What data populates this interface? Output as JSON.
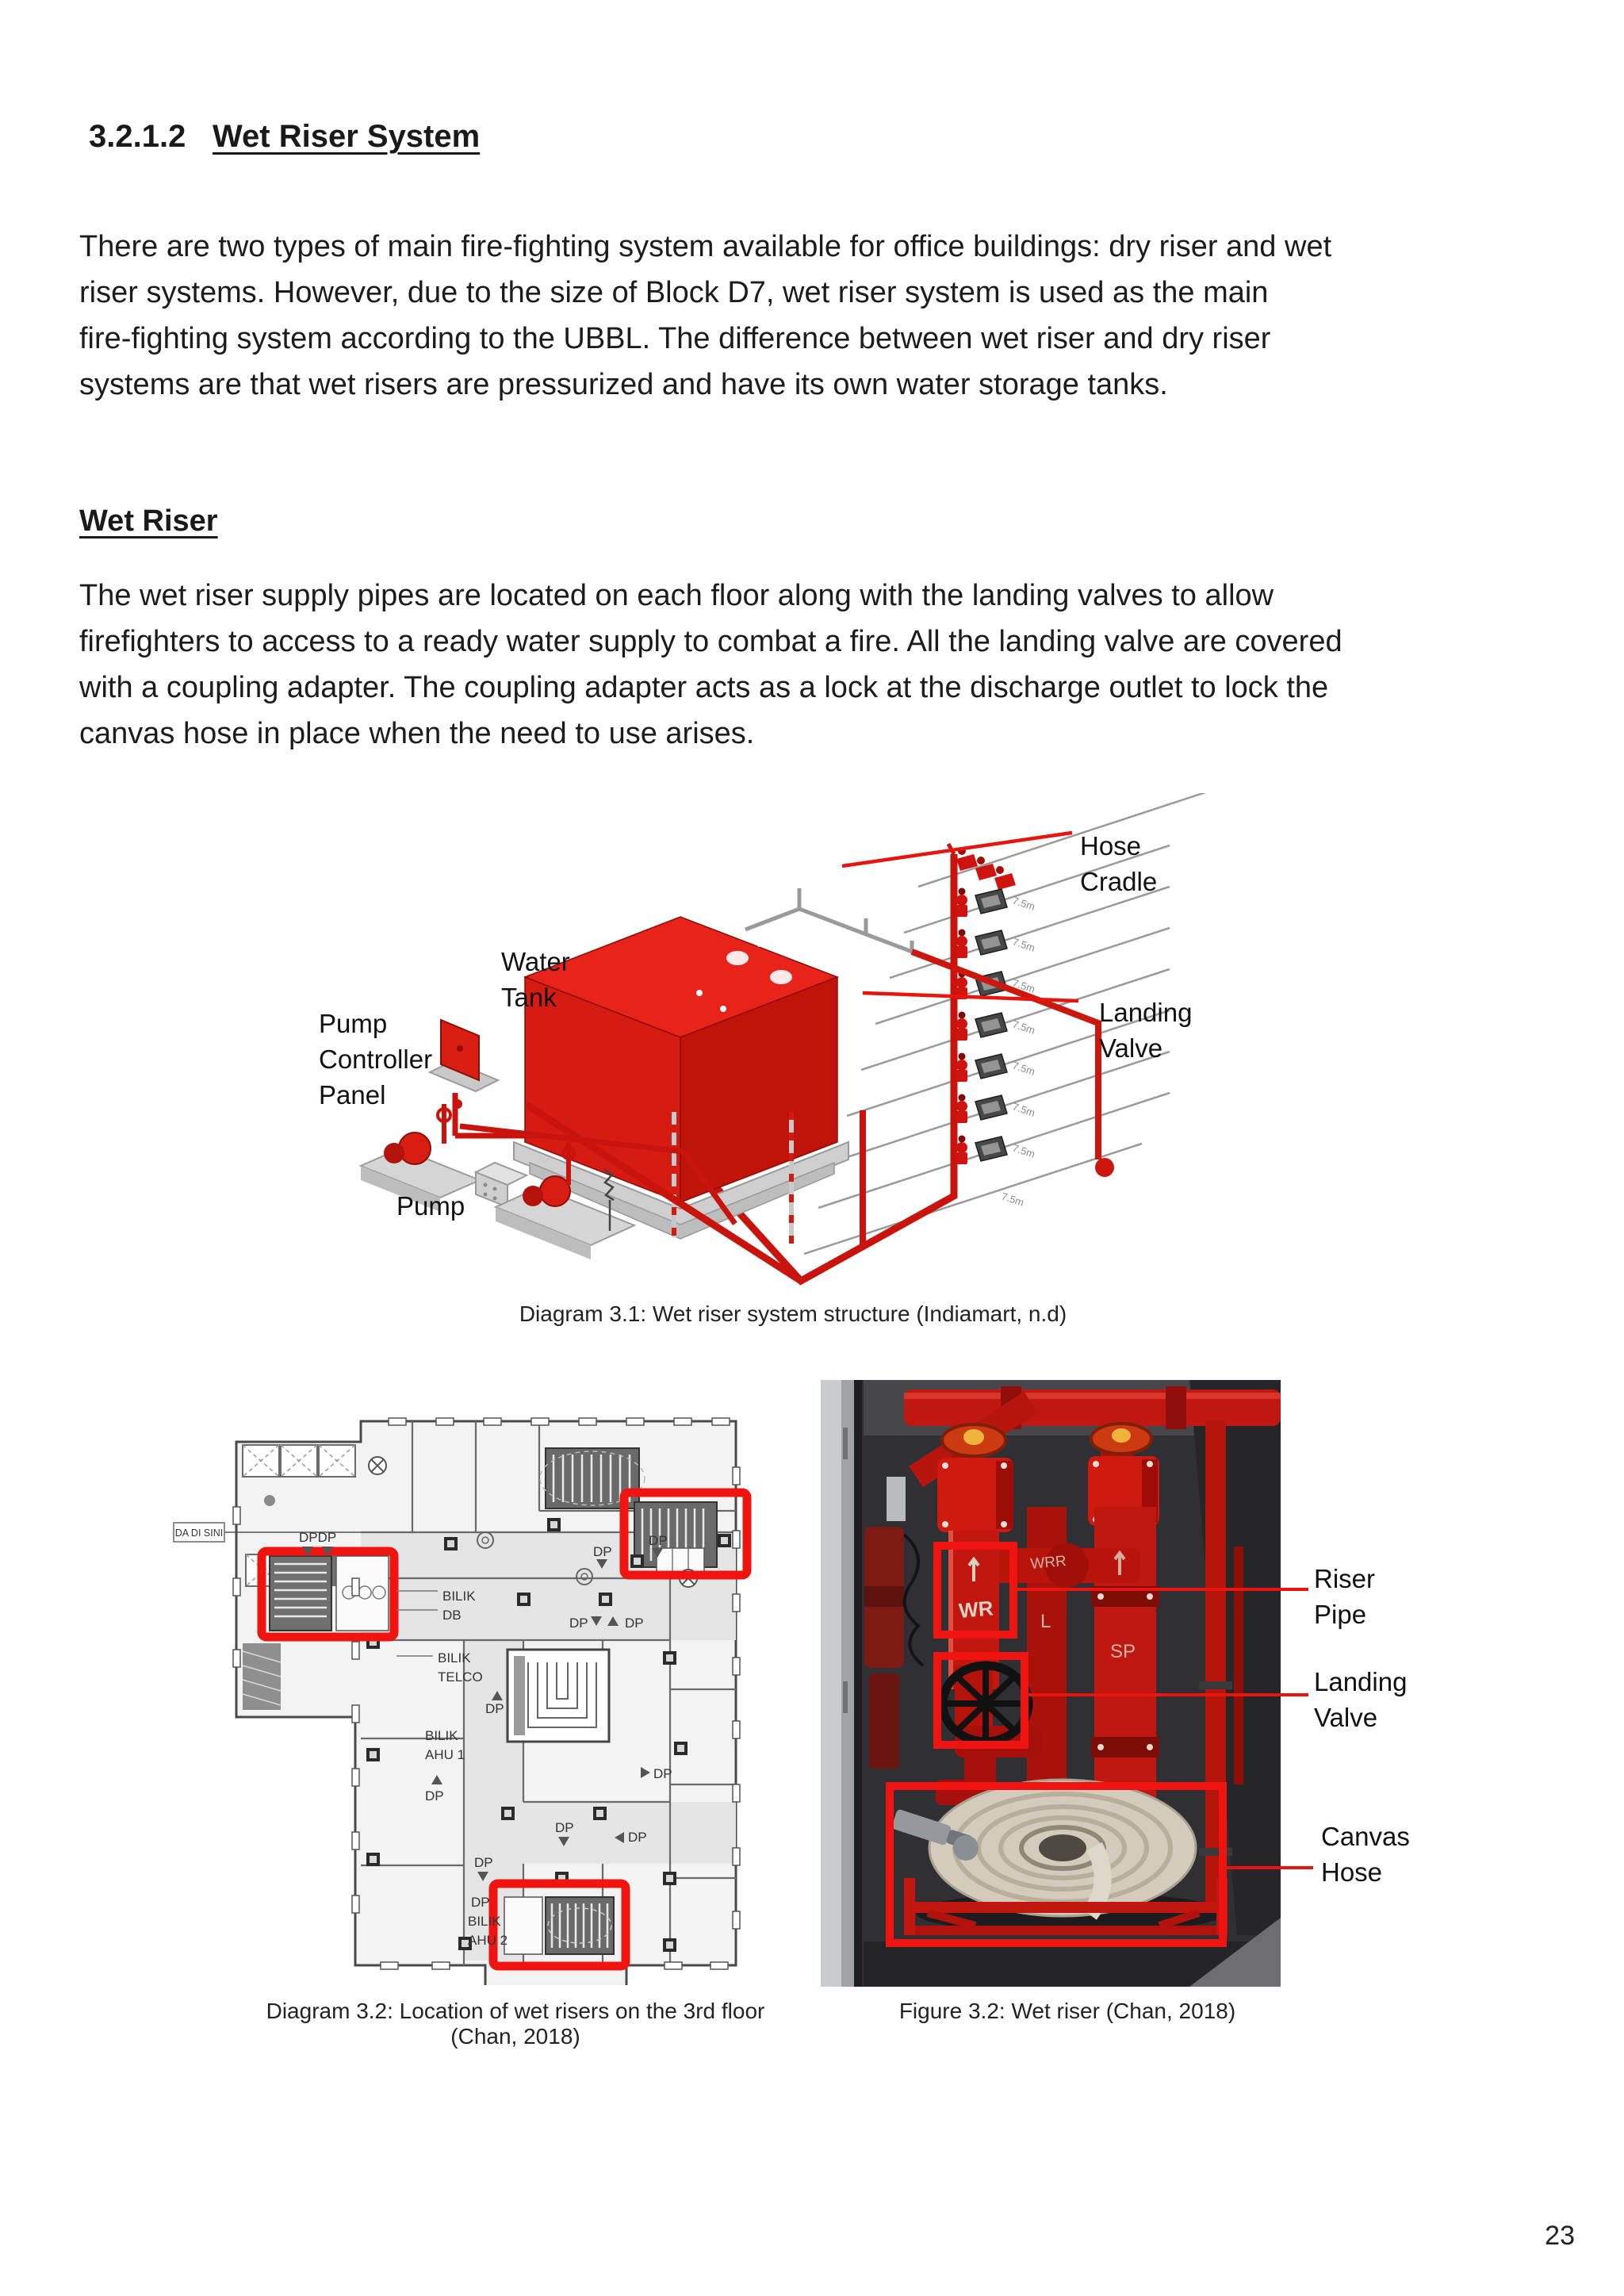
{
  "page": {
    "number": "23"
  },
  "heading": {
    "number": "3.2.1.2",
    "title": "Wet Riser System"
  },
  "intro": {
    "lines": [
      "There are two types of main fire-fighting system available for office buildings: dry riser and wet",
      "riser systems. However, due to the size of Block D7, wet riser system is used as the main",
      "fire-fighting system according to the UBBL. The difference between wet riser and dry riser",
      "systems are that wet risers are pressurized and have its own water storage tanks."
    ]
  },
  "wet_riser_section": {
    "subheading": "Wet Riser",
    "lines": [
      "The wet riser supply pipes are located on each floor along with the landing valves to allow",
      "firefighters to access to a ready water supply to combat a fire. All the landing valve are covered",
      "with a coupling adapter. The coupling adapter acts as a lock at the discharge outlet to lock the",
      "canvas hose in place when the need to use arises."
    ]
  },
  "diagram31": {
    "caption": "Diagram 3.1: Wet riser system structure  (Indiamart, n.d)",
    "labels": {
      "hose_cradle_1": "Hose",
      "hose_cradle_2": "Cradle",
      "water_tank_1": "Water",
      "water_tank_2": "Tank",
      "pump_controller_1": "Pump",
      "pump_controller_2": "Controller",
      "pump_controller_3": "Panel",
      "landing_valve_1": "Landing",
      "landing_valve_2": "Valve",
      "pump": "Pump"
    },
    "floor_height_marking": "7.5m"
  },
  "diagram32": {
    "caption_line1": "Diagram 3.2: Location of wet risers on the 3rd floor",
    "caption_line2": "(Chan, 2018)",
    "plan": {
      "you_are_here": "DA DI SINI",
      "dp_pair": "DPDP",
      "dp": "DP",
      "bilik": "BILIK",
      "db": "DB",
      "telco": "TELCO",
      "ahu1": "AHU 1",
      "ahu2": "AHU 2"
    }
  },
  "figure32": {
    "caption": "Figure 3.2: Wet riser  (Chan, 2018)",
    "labels": {
      "riser_pipe_1": "Riser",
      "riser_pipe_2": "Pipe",
      "landing_valve_1": "Landing",
      "landing_valve_2": "Valve",
      "canvas_hose_1": "Canvas",
      "canvas_hose_2": "Hose"
    },
    "pipe_markings": {
      "wr": "WR",
      "wrr": "WRR",
      "l": "L",
      "sp": "SP"
    }
  },
  "colors": {
    "accent_red": "#e8150e",
    "pipe_red": "#c8150c",
    "highlight_red": "#f01410"
  }
}
